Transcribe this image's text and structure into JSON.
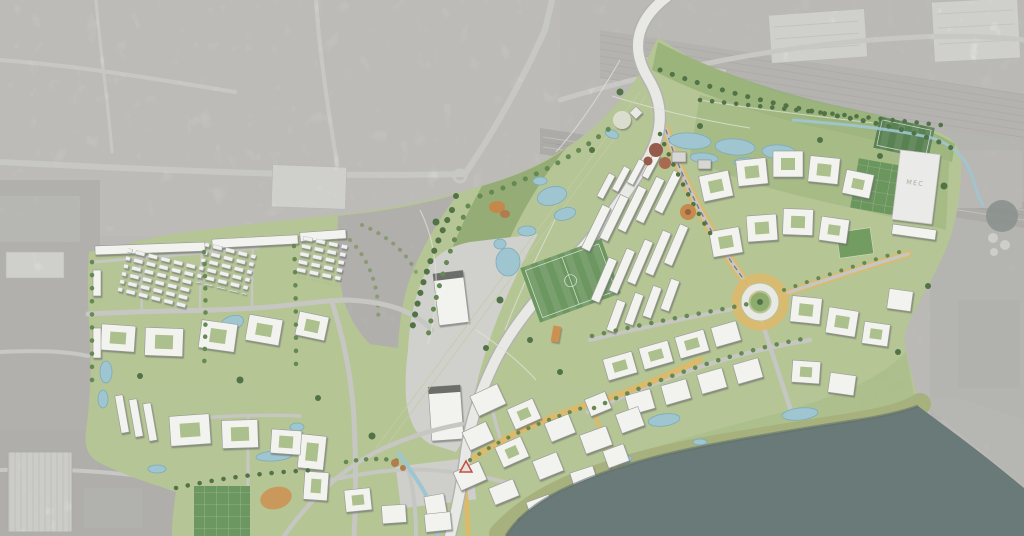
{
  "map": {
    "type": "masterplan-aerial-visualisation",
    "labels": {
      "mec_building": "MEC"
    },
    "colors": {
      "aerial_light": "#c8c7c2",
      "aerial_mid": "#bab9b4",
      "aerial_dark": "#a09f9b",
      "aerial_road": "#dadad5",
      "rail_gray": "#9e9b95",
      "plan_green": "#b4c98c",
      "park_dark": "#92af6c",
      "wood_green": "#87a563",
      "bank_olive": "#a3b072",
      "pitch_green": "#5f9150",
      "pitch_dark": "#47763f",
      "tree_green": "#557f3f",
      "tree_dark": "#3e6432",
      "tree_autumn": "#b0703a",
      "tree_red": "#8e4836",
      "pond_blue": "#9ac8d6",
      "pond_edge": "#6fa8bd",
      "water_teal": "#5a6e6c",
      "road_white": "#f1f2ee",
      "road_gray": "#c9c9c4",
      "street_yellow": "#e2ba5e",
      "accent_orange": "#d0883c",
      "bld_white": "#fdfdfa",
      "bld_edge": "#90938f",
      "plaza_gray": "#d2d2cd",
      "platform_gray": "#d5d5d0",
      "label_gray": "#a6a69e",
      "marker_red": "#c43a2c"
    },
    "features": [
      "grayscale-aerial-context",
      "railway-corridor",
      "rail-yard",
      "masterplan-overlay",
      "central-park",
      "wetland-cells",
      "main-curved-link-road",
      "boulevard-avenue",
      "roundabout",
      "fan-housing-rows",
      "perimeter-housing-blocks",
      "waterfront-quarter",
      "west-neighbourhood",
      "sports-pitches",
      "mec-building",
      "ponds",
      "canal-stream",
      "riverbank",
      "river-water",
      "site-marker"
    ]
  }
}
